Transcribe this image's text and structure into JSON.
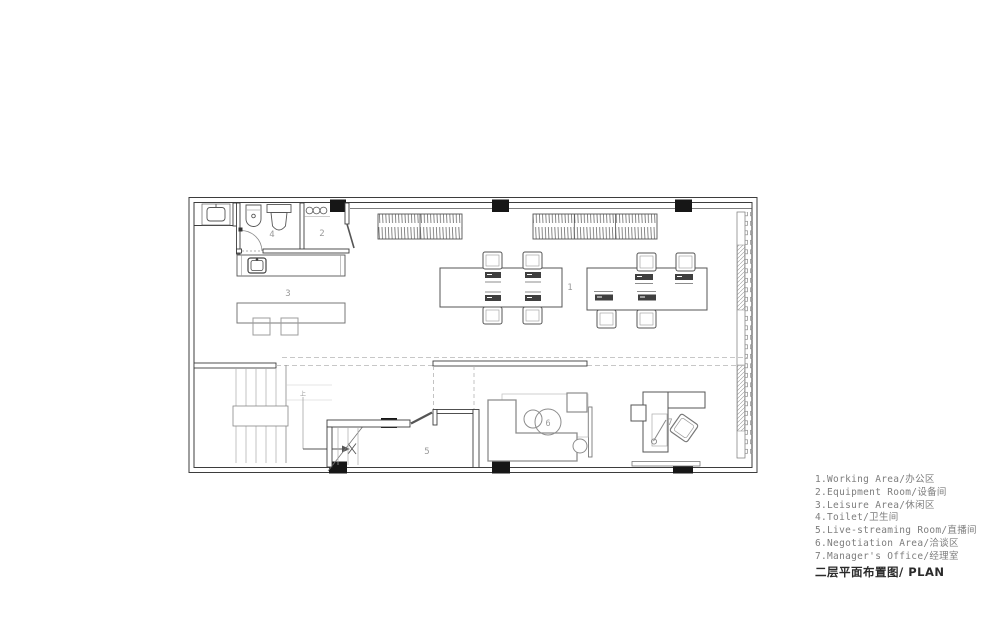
{
  "colors": {
    "wall": "#3d3d3d",
    "furniture": "#8c8c8c",
    "light_line": "#b5b5b5",
    "room_label": "#9a9a9a",
    "column": "#161616",
    "legend_text": "#7d7d7d",
    "title_text": "#2b2b2b",
    "background": "#ffffff"
  },
  "plan": {
    "labels": {
      "r1": "1",
      "r2": "2",
      "r3": "3",
      "r4": "4",
      "r5": "5",
      "r6": "6",
      "r7": "7",
      "stair_up": "上"
    }
  },
  "legend": {
    "items": [
      "1.Working Area/办公区",
      "2.Equipment Room/设备间",
      "3.Leisure Area/休闲区",
      "4.Toilet/卫生间",
      "5.Live-streaming Room/直播间",
      "6.Negotiation Area/洽谈区",
      "7.Manager's Office/经理室"
    ],
    "title": "二层平面布置图/ PLAN"
  }
}
